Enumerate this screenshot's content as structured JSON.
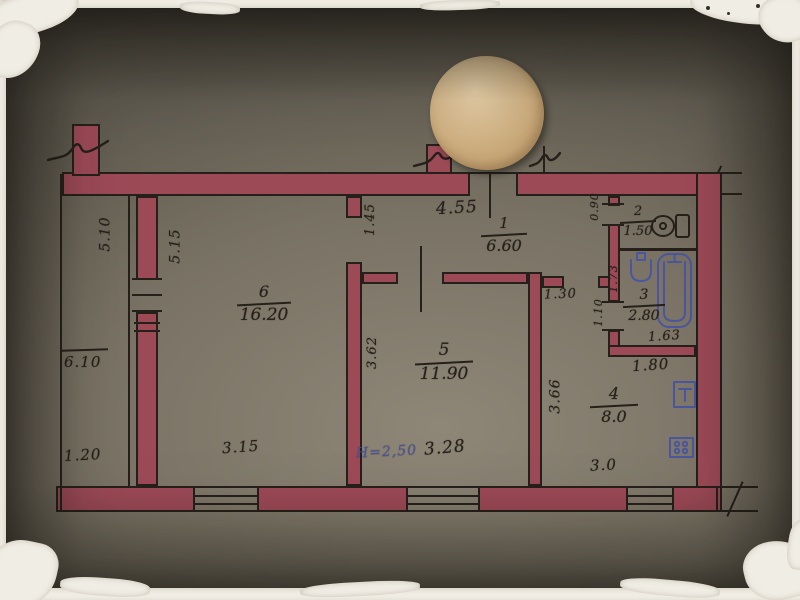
{
  "colors": {
    "wall": "#9d4a57",
    "ink": "#26201a",
    "blue": "#4a57a0",
    "seal": "#c8a878",
    "paper_light": "#8e8677",
    "paper_dark": "#47443c",
    "mount": "#f0ede4"
  },
  "plan": {
    "rooms": [
      {
        "number": "1",
        "area": "6.60"
      },
      {
        "number": "2",
        "area": "1.50"
      },
      {
        "number": "3",
        "area": "2.80",
        "area_extra": "1.63"
      },
      {
        "number": "4",
        "area": "8.0"
      },
      {
        "number": "5",
        "area": "11.90"
      },
      {
        "number": "6",
        "area": "16.20"
      }
    ],
    "dims": {
      "entry_width": "4.55",
      "hall_depth": "1.45",
      "wc_door": "0.90",
      "bath_width": "1.73",
      "bath_door": "1.10",
      "bath_pass": "1.30",
      "below_bath": "1.80",
      "room5_depth": "3.62",
      "kitchen_depth": "3.66",
      "left_outer": "5.10",
      "left_inner": "5.15",
      "balcony_length": "6.10",
      "balcony_width": "1.20",
      "room6_width": "3.15",
      "ceiling_height": "Н=2,50",
      "room5_width": "3.28",
      "kitchen_width": "3.0"
    }
  }
}
